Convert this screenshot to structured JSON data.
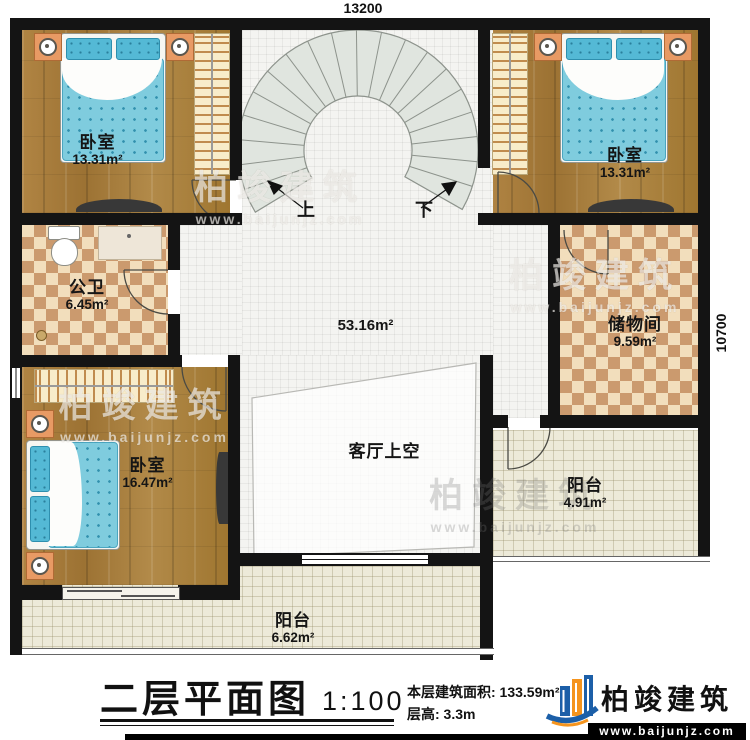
{
  "dimensions": {
    "top": "13200",
    "right": "10700"
  },
  "stairs": {
    "up": "上",
    "down": "下"
  },
  "rooms": {
    "bedroom_tl": {
      "name": "卧室",
      "area": "13.31m²"
    },
    "bedroom_tr": {
      "name": "卧室",
      "area": "13.31m²"
    },
    "bathroom": {
      "name": "公卫",
      "area": "6.45m²"
    },
    "storage": {
      "name": "储物间",
      "area": "9.59m²"
    },
    "bedroom_bl": {
      "name": "卧室",
      "area": "16.47m²"
    },
    "hall": {
      "area": "53.16m²"
    },
    "void": {
      "name": "客厅上空"
    },
    "balcony_right": {
      "name": "阳台",
      "area": "4.91m²"
    },
    "balcony_bottom": {
      "name": "阳台",
      "area": "6.62m²"
    }
  },
  "title_block": {
    "title": "二层平面图",
    "scale": "1:100",
    "area_label": "本层建筑面积: 133.59m²",
    "height_label": "层高: 3.3m"
  },
  "brand": {
    "name": "柏竣建筑",
    "url": "www.baijunjz.com"
  },
  "watermark": {
    "name": "柏竣建筑",
    "url": "www.baijunjz.com"
  },
  "colors": {
    "wall": "#141414",
    "wood": "#a97f3e",
    "tile_cream": "#f2debc",
    "tile_tan": "#cb9a6e",
    "balcony": "#edead9",
    "hall_tile": "#f4f4f1",
    "stair_fill": "#e0e5df",
    "bed_blue": "#7fccde",
    "brand_blue": "#1c5fa8",
    "brand_orange": "#f5941d"
  }
}
